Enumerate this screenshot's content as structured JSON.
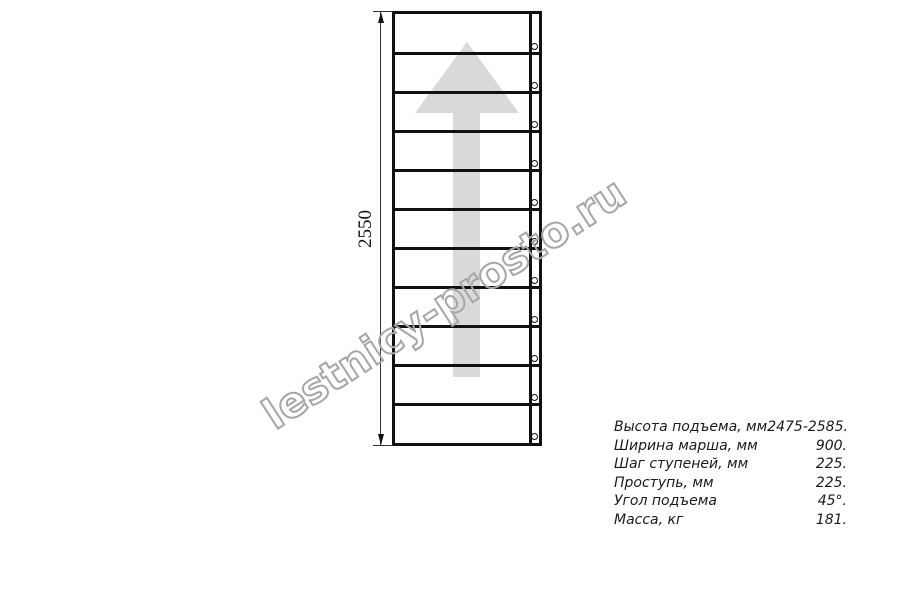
{
  "diagram": {
    "type": "stair-flight-plan-view",
    "dimension_label": "2550",
    "tread_count": 11,
    "arrow_color": "#d9d9d9",
    "line_color": "#111111"
  },
  "watermark": {
    "text": "lestnicy-prosto.ru",
    "color": "#a6a6a6"
  },
  "spec_table": {
    "rows": [
      {
        "label": "Высота подъема, мм",
        "value": "2475-2585."
      },
      {
        "label": "Ширина марша, мм",
        "value": "900."
      },
      {
        "label": "Шаг ступеней, мм",
        "value": "225."
      },
      {
        "label": "Проступь, мм",
        "value": "225."
      },
      {
        "label": "Угол подъема",
        "value": "45°."
      },
      {
        "label": "Масса, кг",
        "value": "181."
      }
    ]
  }
}
